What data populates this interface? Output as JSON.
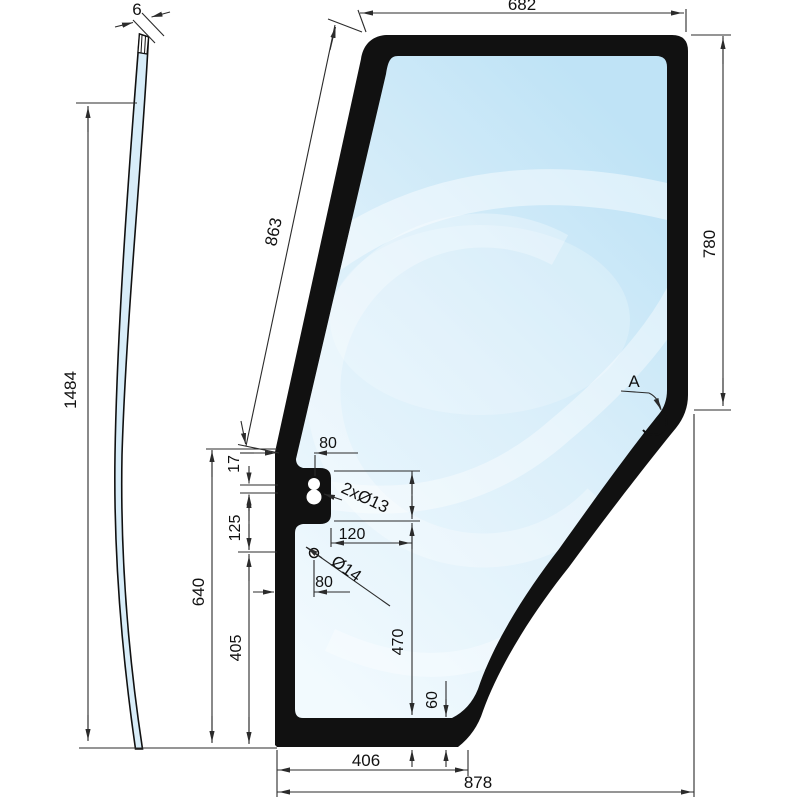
{
  "drawing": {
    "title_hint": "door glass technical drawing",
    "side_view": {
      "thickness": "6",
      "total_height": "1484"
    },
    "front_view": {
      "top_width": "682",
      "left_edge_length": "863",
      "right_edge_height": "780",
      "left_section_total": "640",
      "hole_pair_gap": "17",
      "hole_group_spacing": "125",
      "lower_left_section": "405",
      "tab_hole_offset": "80",
      "tab_holes_label": "2xØ13",
      "hole_span_width": "120",
      "round_hole_label": "Ø14",
      "round_hole_offset": "80",
      "mid_section_height": "470",
      "bottom_edge_inset": "60",
      "bottom_width": "406",
      "total_width": "878",
      "detail_label": "A"
    },
    "colors": {
      "outline": "#111111",
      "dim_line": "#2b2b2b",
      "glass_deep": "#bfe3f6",
      "glass_mid": "#dbeffa",
      "glass_light": "#f2fafe",
      "side_glass": "#d8edf9"
    }
  }
}
